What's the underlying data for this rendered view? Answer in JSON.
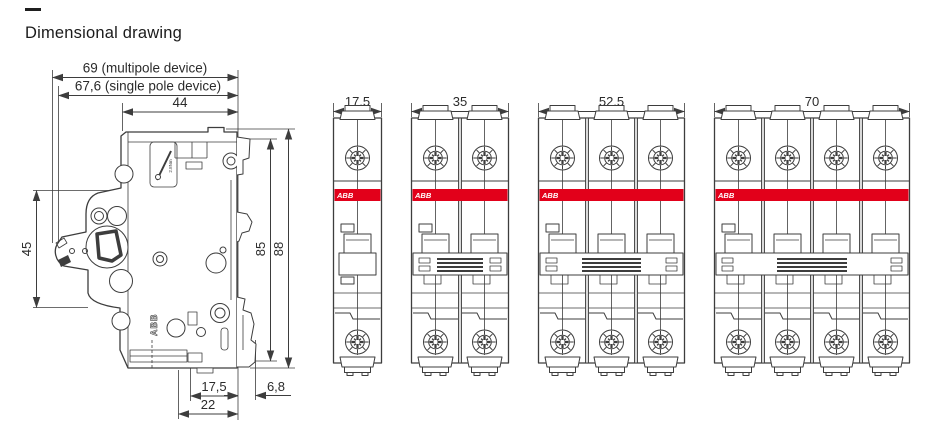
{
  "page": {
    "dash": "—",
    "title": "Dimensional drawing"
  },
  "colors": {
    "line": "#3d3d3d",
    "abb_red": "#e2001a",
    "band_text": "#ffffff",
    "dim_text": "#2b2b2b"
  },
  "side_view": {
    "dims": {
      "multipole_width": "69 (multipole device)",
      "single_pole_width": "67,6 (single pole device)",
      "front_width": "44",
      "handle_height": "45",
      "body_height": "85",
      "total_height": "88",
      "base_width": "17,5",
      "clip_depth": "6,8",
      "base_depth": "22"
    },
    "brand": "ABB",
    "torque": "2.8Nm"
  },
  "front_views": [
    {
      "poles": 1,
      "width": "17,5",
      "brand": "ABB"
    },
    {
      "poles": 2,
      "width": "35",
      "brand": "ABB"
    },
    {
      "poles": 3,
      "width": "52,5",
      "brand": "ABB"
    },
    {
      "poles": 4,
      "width": "70",
      "brand": "ABB"
    }
  ]
}
